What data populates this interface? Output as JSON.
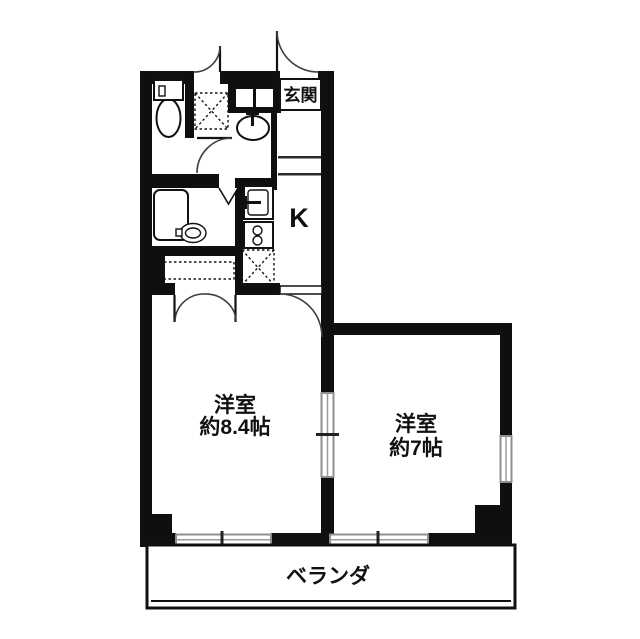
{
  "floorplan": {
    "entrance": {
      "label": "玄関"
    },
    "kitchen": {
      "label": "K"
    },
    "rooms": [
      {
        "name": "洋室",
        "size": "約8.4帖"
      },
      {
        "name": "洋室",
        "size": "約7帖"
      }
    ],
    "veranda": {
      "label": "ベランダ"
    },
    "fixtures": [
      "toilet",
      "washing-machine-space",
      "washbasin",
      "bathtub",
      "kitchen-sink",
      "gas-stove",
      "refrigerator-space",
      "closet"
    ],
    "colors": {
      "wall": "#0f0f0f",
      "background": "#ffffff",
      "window_frame": "#8f8f8f",
      "door_arc": "#3f3f3f"
    }
  }
}
